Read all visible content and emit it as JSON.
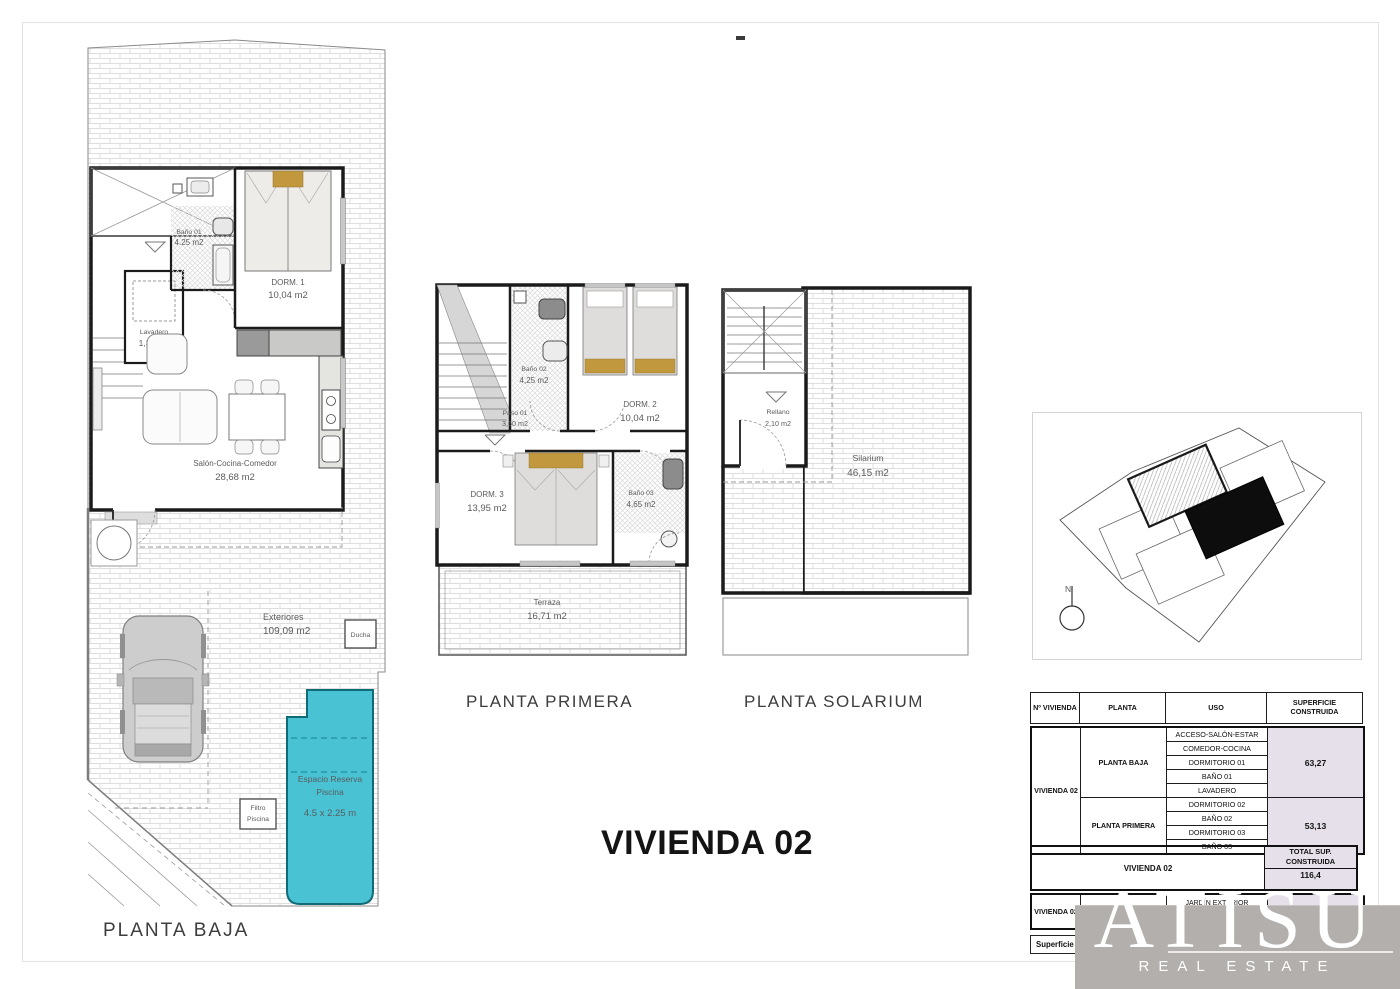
{
  "title": "VIVIENDA 02",
  "plans": {
    "baja": {
      "title": "PLANTA BAJA",
      "bano": {
        "name": "Baño 01",
        "area": "4.25 m2"
      },
      "lavadero": {
        "name": "Lavadero",
        "area": "1,33 m2"
      },
      "dorm1": {
        "name": "DORM. 1",
        "area": "10,04 m2"
      },
      "salon": {
        "name": "Salón-Cocina-Comedor",
        "area": "28,68 m2"
      },
      "exteriores": {
        "name": "Exteriores",
        "area": "109,09 m2"
      },
      "ducha": "Ducha",
      "filtro1": "Filtro",
      "filtro2": "Piscina",
      "pool": {
        "line1": "Espacio Reserva",
        "line2": "Piscina",
        "line3": "4.5 x 2.25 m"
      }
    },
    "primera": {
      "title": "PLANTA PRIMERA",
      "bano2": {
        "name": "Baño 02",
        "area": "4,25 m2"
      },
      "paso": {
        "name": "Paso 01",
        "area": "3,60 m2"
      },
      "dorm2": {
        "name": "DORM. 2",
        "area": "10,04 m2"
      },
      "dorm3": {
        "name": "DORM. 3",
        "area": "13,95 m2"
      },
      "bano3": {
        "name": "Baño 03",
        "area": "4,65 m2"
      },
      "terraza": {
        "name": "Terraza",
        "area": "16,71 m2"
      }
    },
    "solarium": {
      "title": "PLANTA SOLARIUM",
      "rellano": {
        "name": "Rellano",
        "area": "2,10 m2"
      },
      "room": {
        "name": "Silarium",
        "area": "46,15 m2"
      }
    }
  },
  "site": {
    "north": "N"
  },
  "table": {
    "header": {
      "c1": "Nº VIVIENDA",
      "c2": "PLANTA",
      "c3": "USO",
      "c4a": "SUPERFICIE",
      "c4b": "CONSTRUIDA"
    },
    "vivienda": "VIVIENDA 02",
    "groups": [
      {
        "planta": "PLANTA BAJA",
        "usos": [
          "ACCESO-SALÓN-ESTAR",
          "COMEDOR-COCINA",
          "DORMITORIO 01",
          "BAÑO 01",
          "LAVADERO"
        ],
        "superficie": "63,27"
      },
      {
        "planta": "PLANTA PRIMERA",
        "usos": [
          "DORMITORIO 02",
          "BAÑO 02",
          "DORMITORIO 03",
          "BAÑO 03"
        ],
        "superficie": "53,13"
      }
    ],
    "total": {
      "left": "VIVIENDA 02",
      "l1": "TOTAL SUP.",
      "l2": "CONSTRUIDA",
      "value": "116,4"
    },
    "ext": {
      "c1": "VIVIENDA 02",
      "c2": "EXTERIORES",
      "u1": "JARDÍN EXTERIOR",
      "u2": "PATIO",
      "value": "109,09"
    },
    "parcela": {
      "label": "Superficie de Parcela",
      "value": "168,79"
    }
  },
  "logo": {
    "name": "ATISU",
    "tagline": "REAL ESTATE"
  },
  "colors": {
    "pool": "#49c3d4",
    "pool_text": "#0a525c",
    "accent_cell": "#e6e0ea",
    "logo_band": "#b3afac",
    "bed_tan": "#c2983f",
    "wall": "#1b1b1b"
  }
}
